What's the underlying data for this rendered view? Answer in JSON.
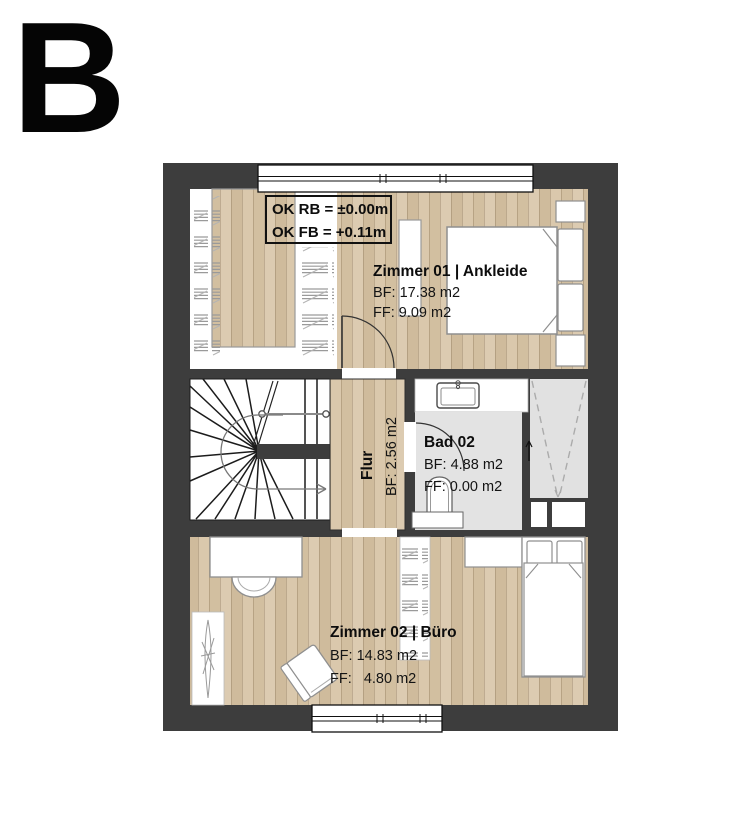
{
  "variant_label": "B",
  "annotation_box": {
    "line1": "OK RB = ±0.00m",
    "line2": "OK FB = +0.11m"
  },
  "rooms": {
    "zimmer01": {
      "name": "Zimmer 01 | Ankleide",
      "bf": "BF: 17.38 m2",
      "ff": "FF: 9.09 m2"
    },
    "flur": {
      "name": "Flur",
      "bf": "BF: 2.56 m2"
    },
    "bad02": {
      "name": "Bad 02",
      "bf": "BF: 4.88 m2",
      "ff": "FF: 0.00 m2"
    },
    "zimmer02": {
      "name": "Zimmer 02 | Büro",
      "bf": "BF: 14.83 m2",
      "ff": "FF:   4.80 m2"
    }
  },
  "colors": {
    "wall": "#3d3d3d",
    "wood": "#d7c5a8",
    "tile": "#e3e3e3",
    "text": "#0d0d0d"
  }
}
